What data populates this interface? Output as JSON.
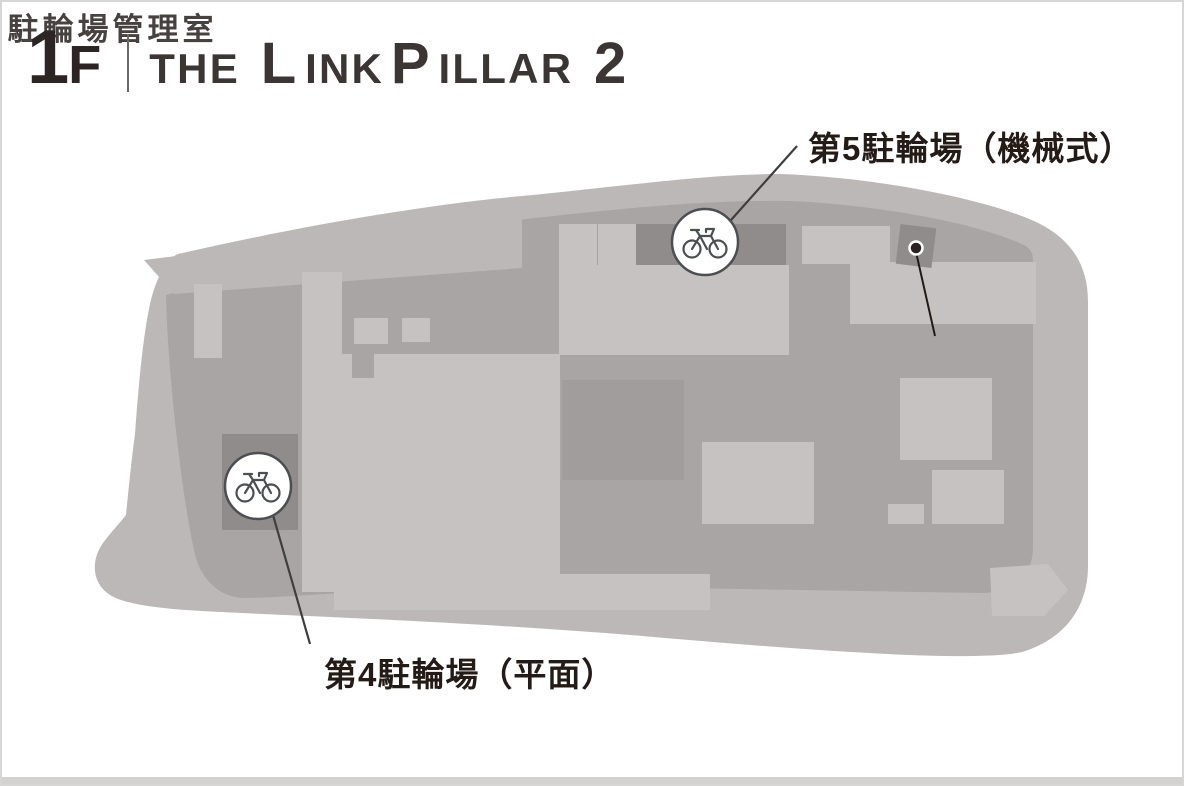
{
  "header": {
    "floor": {
      "number": "1",
      "suffix": "F"
    },
    "title": {
      "the": "THE",
      "link_cap": "L",
      "link_rest": "INK",
      "pillar_cap": "P",
      "pillar_rest": "ILLAR",
      "suffix_number": "2"
    }
  },
  "map": {
    "labels": {
      "parking5": "第5駐輪場（機械式）",
      "office": "駐輪場管理室",
      "parking4": "第4駐輪場（平面）"
    },
    "icons": {
      "bicycle": "bicycle-icon",
      "location_dot": "location-dot"
    },
    "colors": {
      "site_base": "#bcb8b7",
      "inner_area": "#a9a5a4",
      "block_light": "#c6c2c1",
      "block_dark": "#8f8c8b",
      "block_mid": "#a19d9c",
      "marker_stroke": "#4b4f52",
      "callout_line": "#3e3e40",
      "label_text": "#241b17",
      "frame_border": "#d8d6d5"
    }
  }
}
